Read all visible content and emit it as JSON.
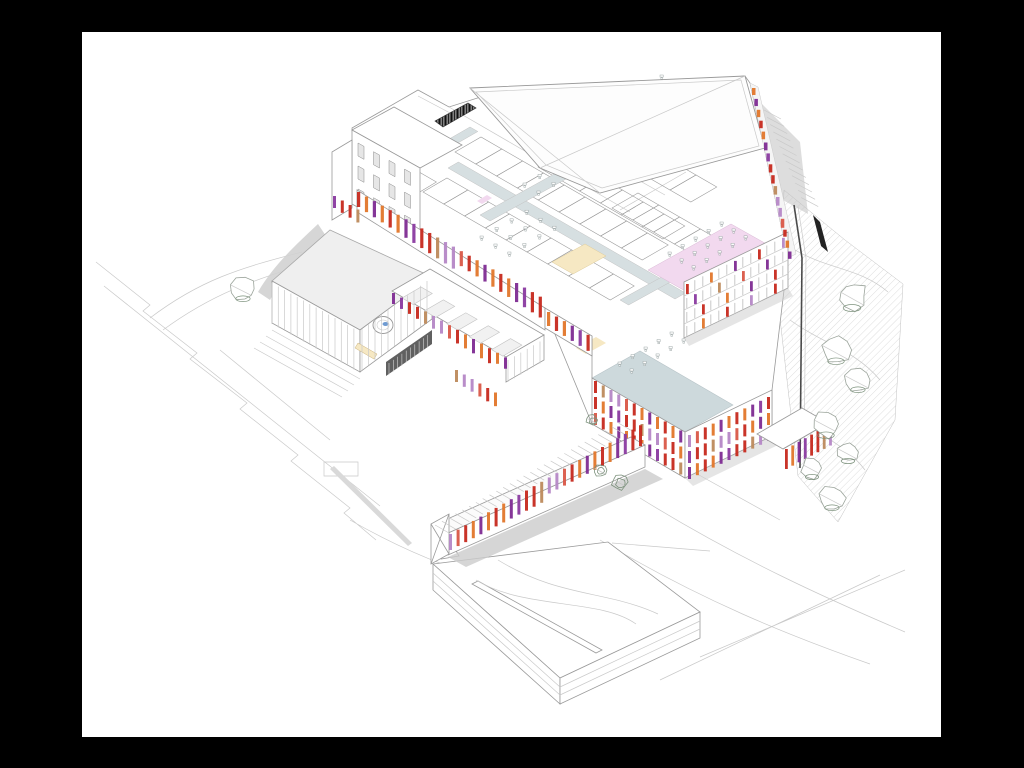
{
  "figure": {
    "kind": "architectural axonometric cutaway drawing of a building complex",
    "visible_text": "none"
  },
  "colors": {
    "frame": "#000000",
    "paper": "#ffffff",
    "line_faint": "#c9c9c9",
    "line_mid": "#9a9a9a",
    "line_dark": "#4a4a4a",
    "roof_gray": "#efefef",
    "ramp_gray": "#d2d2d2",
    "shadow_gray": "#cccccc",
    "steps_gray": "#d9d9d9",
    "corridor_floor": "#d6dfe1",
    "terrace_floor": "#cdd9dc",
    "hall_pink": "#f2d9ef",
    "hall_cream": "#f6e8c3",
    "hall_lilac": "#e8d7f0",
    "window_gray": "#d8d8d8",
    "dark_glazing": "#4f4f4f",
    "tree_line": "#9aa39a",
    "tree_green": "#7d927d",
    "water_blue": "#6f9bd2",
    "barrel_dark": "#777777",
    "stripe_palette": [
      "#c6291d",
      "#e1762a",
      "#7e2b92",
      "#c6291d",
      "#b587c6",
      "#e1762a",
      "#c6291d",
      "#8a3aa0",
      "#bd8a5c",
      "#d95747",
      "#7e2b92",
      "#e1762a",
      "#c6291d",
      "#b587c6"
    ]
  },
  "gen": {
    "stripe_rows": [
      {
        "name": "colonnade",
        "x": 357,
        "y": 192,
        "dx": 7.9,
        "dy": 4.55,
        "n": 24,
        "w": 3.2,
        "hmin": 15,
        "hmax": 22,
        "seed": 0
      },
      {
        "name": "wing-edge",
        "x": 392,
        "y": 293,
        "dx": 8.0,
        "dy": 4.6,
        "n": 15,
        "w": 3.0,
        "hmin": 11,
        "hmax": 15,
        "seed": 2
      },
      {
        "name": "mid-facade",
        "x": 547,
        "y": 312,
        "dx": 7.9,
        "dy": 4.55,
        "n": 6,
        "w": 3.2,
        "hmin": 14,
        "hmax": 19,
        "seed": 1
      },
      {
        "name": "tower-left-1",
        "x": 594,
        "y": 381,
        "dx": 7.75,
        "dy": 4.5,
        "n": 12,
        "w": 3.0,
        "hmin": 12,
        "hmax": 12,
        "seed": 3
      },
      {
        "name": "tower-left-2",
        "x": 594,
        "y": 397,
        "dx": 7.75,
        "dy": 4.5,
        "n": 12,
        "w": 3.0,
        "hmin": 12,
        "hmax": 12,
        "seed": 6
      },
      {
        "name": "tower-left-3",
        "x": 594,
        "y": 413,
        "dx": 7.75,
        "dy": 4.5,
        "n": 12,
        "w": 3.0,
        "hmin": 12,
        "hmax": 12,
        "seed": 9
      },
      {
        "name": "tower-right-1",
        "x": 688,
        "y": 435,
        "dx": 7.9,
        "dy": -3.8,
        "n": 11,
        "w": 3.0,
        "hmin": 12,
        "hmax": 12,
        "seed": 4
      },
      {
        "name": "tower-right-2",
        "x": 688,
        "y": 451,
        "dx": 7.9,
        "dy": -3.8,
        "n": 11,
        "w": 3.0,
        "hmin": 12,
        "hmax": 12,
        "seed": 7
      },
      {
        "name": "tower-right-3",
        "x": 688,
        "y": 467,
        "dx": 7.9,
        "dy": -3.8,
        "n": 11,
        "w": 3.0,
        "hmin": 12,
        "hmax": 12,
        "seed": 10
      },
      {
        "name": "right-block-1",
        "x": 686,
        "y": 284,
        "dx": 8.0,
        "dy": -3.85,
        "n": 13,
        "w": 2.8,
        "hmin": 10,
        "hmax": 10,
        "seed": 0,
        "sparse": true
      },
      {
        "name": "right-block-2",
        "x": 686,
        "y": 298,
        "dx": 8.0,
        "dy": -3.85,
        "n": 13,
        "w": 2.8,
        "hmin": 10,
        "hmax": 10,
        "seed": 2,
        "sparse": true
      },
      {
        "name": "right-block-3",
        "x": 686,
        "y": 312,
        "dx": 8.0,
        "dy": -3.85,
        "n": 13,
        "w": 2.8,
        "hmin": 10,
        "hmax": 10,
        "seed": 4,
        "sparse": true
      },
      {
        "name": "right-block-4",
        "x": 686,
        "y": 326,
        "dx": 8.0,
        "dy": -3.85,
        "n": 13,
        "w": 2.8,
        "hmin": 10,
        "hmax": 10,
        "seed": 1,
        "sparse": true
      },
      {
        "name": "skybridge",
        "layer": "g-bridge-s",
        "x": 449,
        "y": 534,
        "dx": 7.6,
        "dy": -4.35,
        "n": 26,
        "w": 3.0,
        "hmin": 16,
        "hmax": 21,
        "seed": 4
      },
      {
        "name": "edge-tabs",
        "x": 752,
        "y": 88,
        "dx": 2.4,
        "dy": 10.9,
        "n": 16,
        "w": 3.5,
        "hmin": 7,
        "hmax": 9,
        "seed": 5
      },
      {
        "name": "canopy-columns",
        "layer": "g-canopy-s",
        "x": 785,
        "y": 449,
        "dx": 6.3,
        "dy": -3.6,
        "n": 8,
        "w": 2.8,
        "hmin": 20,
        "hmax": 23,
        "seed": 6
      },
      {
        "name": "left-annex",
        "x": 333,
        "y": 196,
        "dx": 7.8,
        "dy": 4.5,
        "n": 4,
        "w": 3.0,
        "hmin": 12,
        "hmax": 16,
        "seed": 7
      },
      {
        "name": "wing-south",
        "x": 455,
        "y": 370,
        "dx": 7.8,
        "dy": 4.5,
        "n": 6,
        "w": 3.0,
        "hmin": 12,
        "hmax": 16,
        "seed": 8
      }
    ],
    "quad_rows": [
      {
        "name": "room-row",
        "layer": "g-rooms",
        "cls": "room",
        "x": 455,
        "y": 152,
        "sx": 20.8,
        "sy": 12,
        "ax": 20.8,
        "ay": 12,
        "bx": 26,
        "by": -15,
        "n": 9
      },
      {
        "name": "room-row",
        "layer": "g-rooms",
        "cls": "room",
        "x": 447,
        "y": 178,
        "sx": 20.8,
        "sy": 12,
        "ax": 20.8,
        "ay": 12,
        "bx": -24,
        "by": 14,
        "n": 9
      },
      {
        "name": "room-row",
        "layer": "g-rooms",
        "cls": "room",
        "x": 566,
        "y": 130,
        "sx": 20.8,
        "sy": 12,
        "ax": 20.8,
        "ay": 12,
        "bx": 26,
        "by": -15,
        "n": 6
      },
      {
        "name": "room-row",
        "layer": "g-rooms",
        "cls": "room",
        "x": 560,
        "y": 154,
        "sx": 20.8,
        "sy": 12,
        "ax": 20.8,
        "ay": 12,
        "bx": -22,
        "by": 13,
        "n": 6
      },
      {
        "name": "room-row",
        "layer": "g-rooms",
        "cls": "room",
        "x": 612,
        "y": 208,
        "sx": 20.8,
        "sy": 12,
        "ax": 20.8,
        "ay": 12,
        "bx": 26,
        "by": -15,
        "n": 5
      },
      {
        "name": "room-row",
        "layer": "g-rooms",
        "cls": "room",
        "x": 374,
        "y": 146,
        "sx": 20.8,
        "sy": 12,
        "ax": 20.8,
        "ay": 12,
        "bx": -20,
        "by": 12,
        "n": 3
      },
      {
        "name": "skylight-panel",
        "layer": "g-fans",
        "cls": "skylight",
        "x": 402,
        "y": 298,
        "sx": 22.4,
        "sy": 12.9,
        "ax": 19,
        "ay": -11,
        "bx": 11.3,
        "by": 6.5,
        "n": 5
      }
    ],
    "win_grids": [
      {
        "x": 358,
        "y": 143,
        "nx": 4,
        "sx": 15.5,
        "sy": 8.7,
        "ny": 3,
        "oy": 23,
        "w": 6,
        "h": 13
      }
    ],
    "desk_areas": [
      {
        "x": 585,
        "y": 118,
        "nu": 6,
        "nv": 3,
        "ux": 15,
        "uy": -8.6,
        "vx": 13.9,
        "vy": 8
      },
      {
        "x": 480,
        "y": 236,
        "nu": 4,
        "nv": 3,
        "ux": 15,
        "uy": -8.6,
        "vx": 13.9,
        "vy": 8
      },
      {
        "x": 668,
        "y": 252,
        "nu": 5,
        "nv": 3,
        "ux": 13,
        "uy": -7.5,
        "vx": 12,
        "vy": 6.9
      },
      {
        "x": 618,
        "y": 362,
        "nu": 5,
        "nv": 2,
        "ux": 13,
        "uy": -7.5,
        "vx": 12,
        "vy": 6.9
      },
      {
        "x": 523,
        "y": 183,
        "nu": 3,
        "nv": 2,
        "ux": 15,
        "uy": -8.6,
        "vx": 13.9,
        "vy": 8
      },
      {
        "x": 668,
        "y": 136,
        "nu": 4,
        "nv": 2,
        "ux": 15,
        "uy": -8.6,
        "vx": 13.9,
        "vy": 8
      }
    ],
    "line_fans": [
      {
        "layer": "g-fans",
        "cls": "lineF",
        "x": 272,
        "y": 283,
        "dx": 6.3,
        "dy": 3.5,
        "n": 14,
        "lx": 0,
        "ly": 41
      },
      {
        "layer": "g-fans",
        "cls": "lineF",
        "x": 362,
        "y": 329,
        "dx": 6.5,
        "dy": -4.8,
        "n": 11,
        "lx": 0,
        "ly": 41
      },
      {
        "layer": "g-fans",
        "cls": "wline",
        "x": 389,
        "y": 363,
        "dx": 4.3,
        "dy": -3.1,
        "n": 10,
        "lx": 0,
        "ly": 12
      },
      {
        "layer": "g-site",
        "cls": "lineF",
        "x": 272,
        "y": 330,
        "dx": -6,
        "dy": 6,
        "n": 4,
        "lx": 88,
        "ly": 49
      },
      {
        "layer": "g-bridge",
        "cls": "lineF",
        "x": 449,
        "y": 533,
        "dx": 6.8,
        "dy": -3.77,
        "n": 28,
        "lx": -13.9,
        "ly": -8
      },
      {
        "layer": "g-terrain",
        "cls": "lineF",
        "x": 764,
        "y": 110,
        "dx": 3.1,
        "dy": 7.3,
        "n": 13,
        "lx": 17,
        "ly": 9
      },
      {
        "layer": "g-fans",
        "cls": "lineF",
        "x": 508,
        "y": 360,
        "dx": 6.4,
        "dy": -3.7,
        "n": 6,
        "lx": 0,
        "ly": 22
      }
    ],
    "trees": {
      "white": [
        [
          852,
          296,
          16
        ],
        [
          836,
          350,
          15
        ],
        [
          858,
          380,
          13
        ],
        [
          826,
          424,
          15
        ],
        [
          848,
          452,
          12
        ],
        [
          812,
          468,
          12
        ],
        [
          832,
          498,
          13
        ],
        [
          243,
          289,
          13
        ]
      ],
      "green": [
        [
          620,
          482,
          9
        ],
        [
          600,
          470,
          7
        ],
        [
          592,
          420,
          6
        ]
      ]
    }
  }
}
